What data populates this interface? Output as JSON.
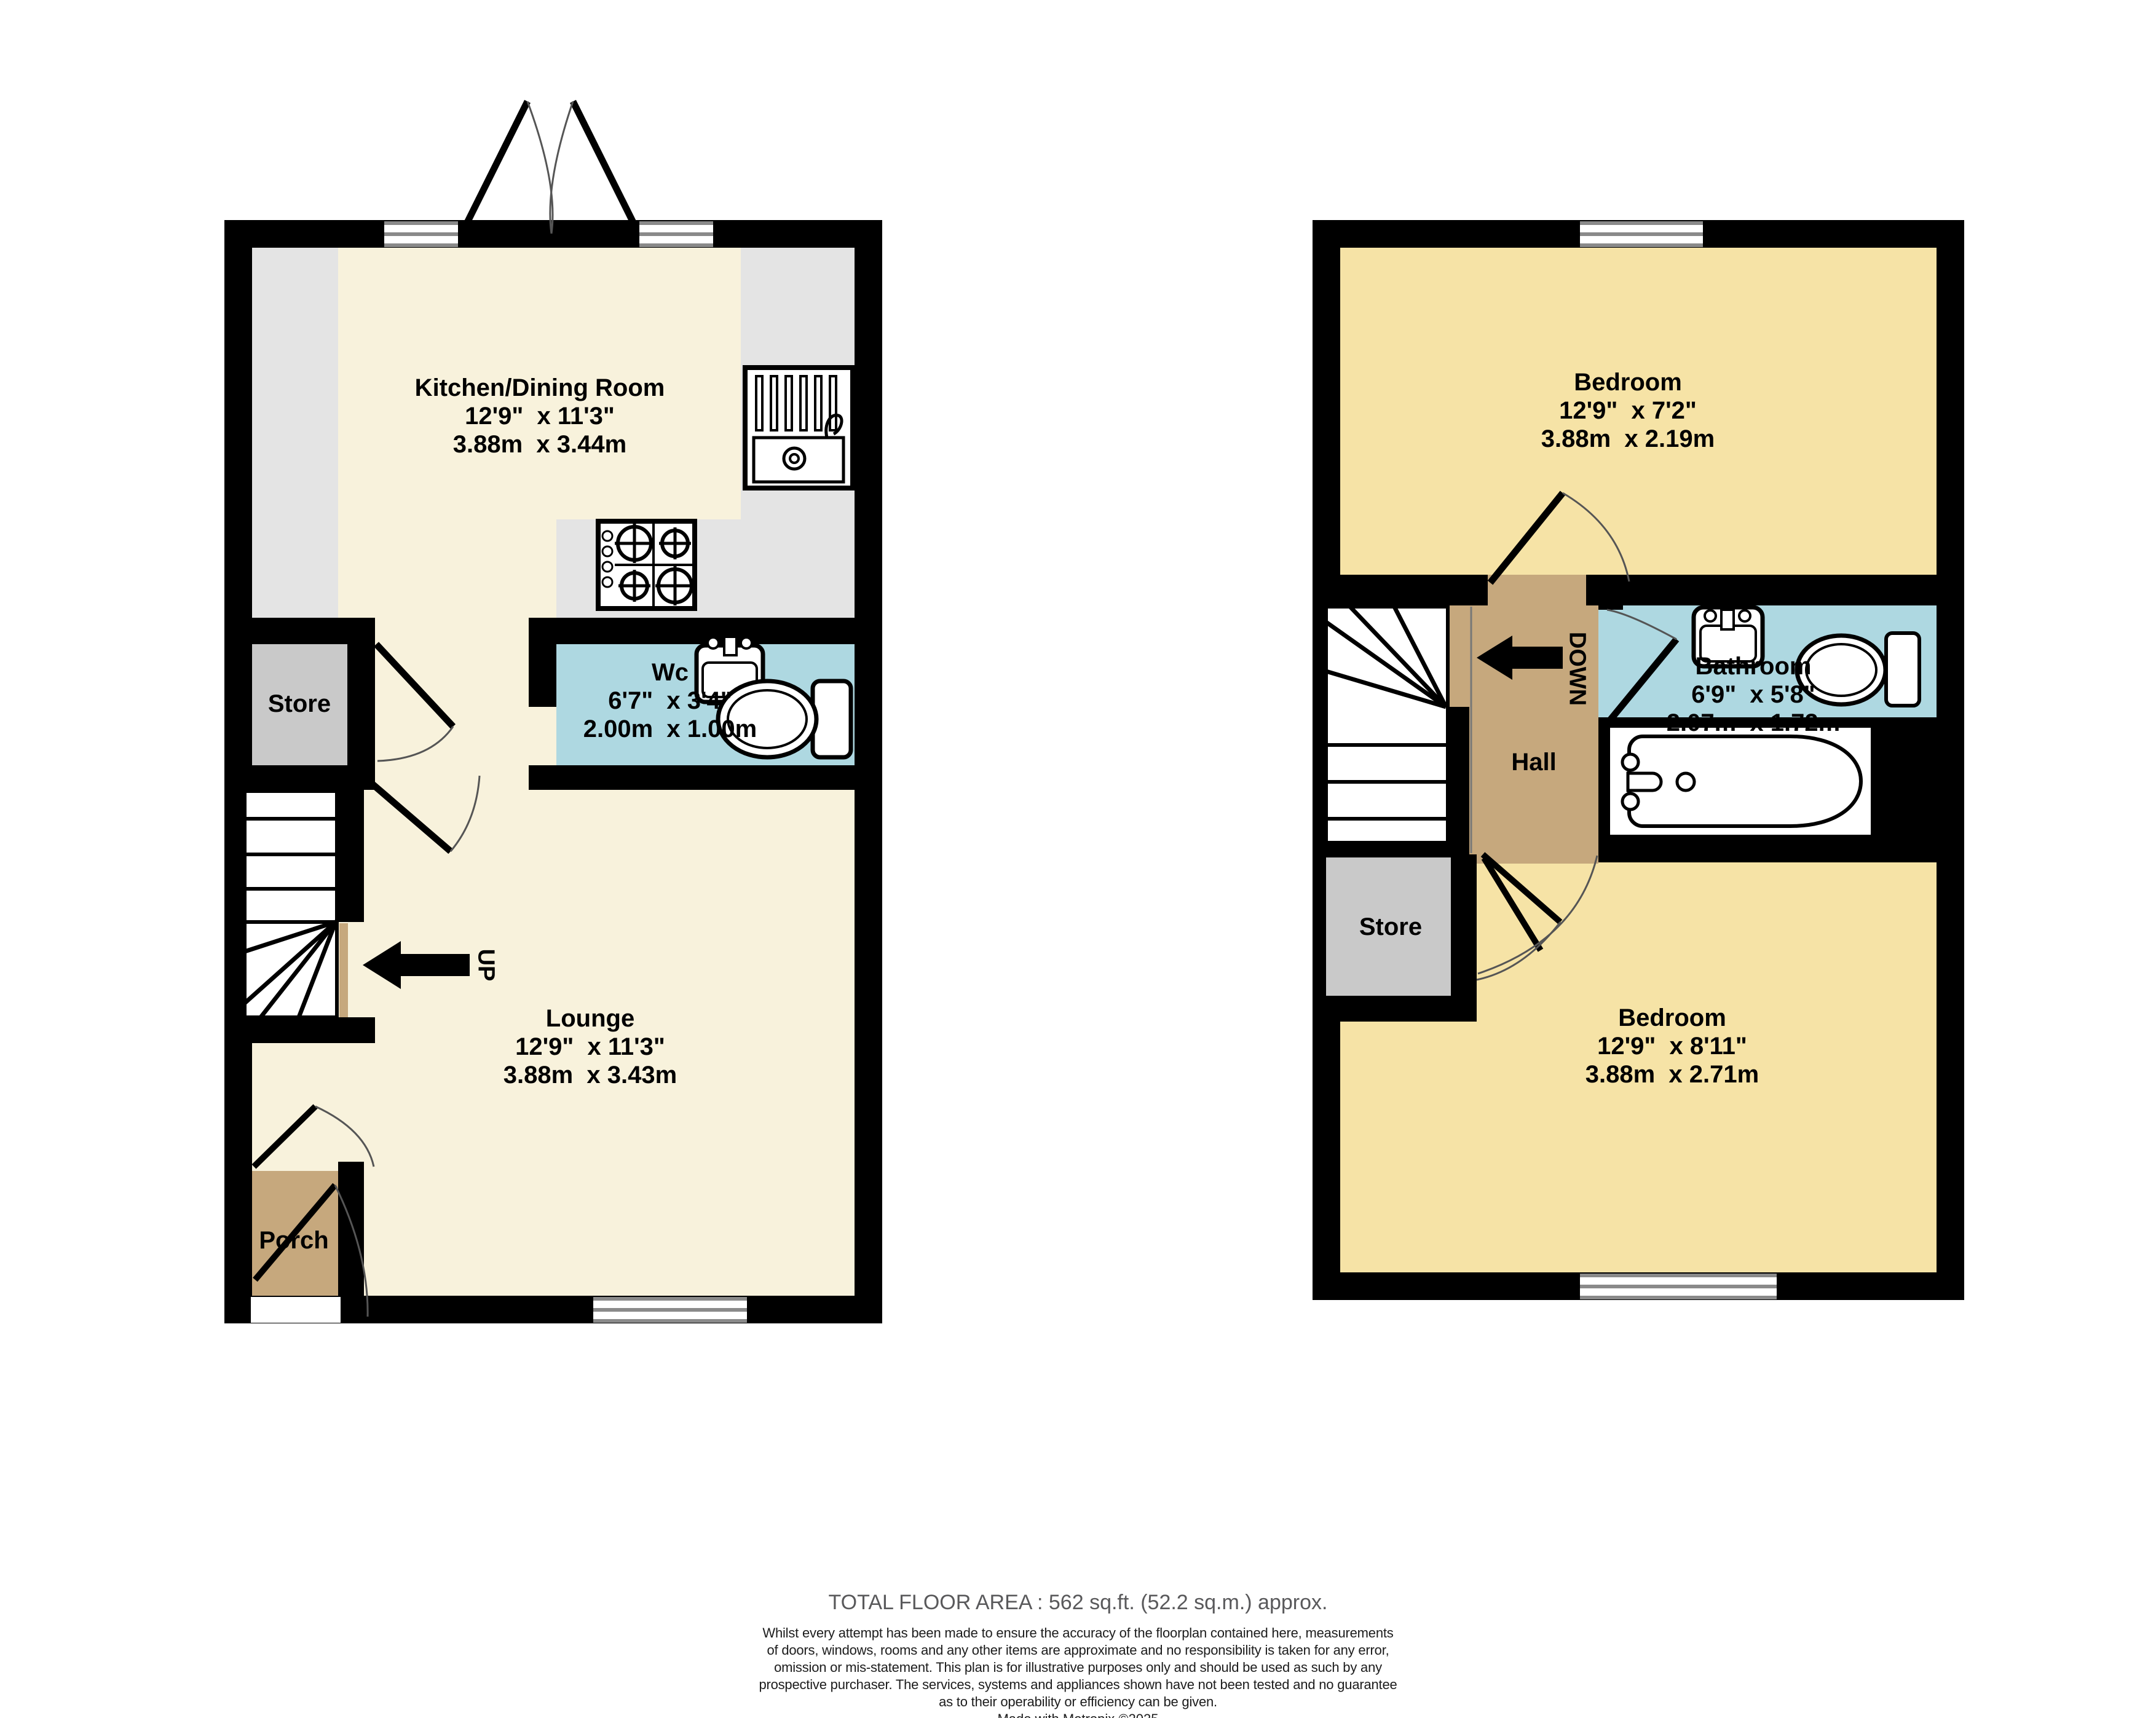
{
  "colors": {
    "wall": "#000000",
    "ground_floor_room": "#f8f2dc",
    "kitchen_counter": "#e4e4e4",
    "store_gray": "#c9c9c9",
    "porch_hall_tan": "#c6a87d",
    "wet_room_blue": "#aed8e1",
    "bedroom_yellow": "#f6e3a6",
    "window_line_gray": "#8a8a8a",
    "footer_title_gray": "#59595b"
  },
  "ground": {
    "kitchen": {
      "name": "Kitchen/Dining Room",
      "imperial": "12'9\"  x 11'3\"",
      "metric": "3.88m  x 3.44m"
    },
    "wc": {
      "name": "Wc",
      "imperial": "6'7\"  x 3'4\"",
      "metric": "2.00m  x 1.00m"
    },
    "store": {
      "name": "Store"
    },
    "lounge": {
      "name": "Lounge",
      "imperial": "12'9\"  x 11'3\"",
      "metric": "3.88m  x 3.43m"
    },
    "porch": {
      "name": "Porch"
    },
    "stair_direction": "UP"
  },
  "first": {
    "bedroom1": {
      "name": "Bedroom",
      "imperial": "12'9\"  x 7'2\"",
      "metric": "3.88m  x 2.19m"
    },
    "bathroom": {
      "name": "Bathroom",
      "imperial": "6'9\"  x 5'8\"",
      "metric": "2.07m  x 1.72m"
    },
    "hall": {
      "name": "Hall"
    },
    "store": {
      "name": "Store"
    },
    "bedroom2": {
      "name": "Bedroom",
      "imperial": "12'9\"  x 8'11\"",
      "metric": "3.88m  x 2.71m"
    },
    "stair_direction": "DOWN"
  },
  "footer": {
    "total_area": "TOTAL FLOOR AREA : 562 sq.ft. (52.2 sq.m.) approx.",
    "disclaimer_lines": [
      "Whilst every attempt has been made to ensure the accuracy of the floorplan contained here, measurements",
      "of doors, windows, rooms and any other items are approximate and no responsibility is taken for any error,",
      "omission or mis-statement. This plan is for illustrative purposes only and should be used as such by any",
      "prospective purchaser. The services, systems and appliances shown have not been tested and no guarantee",
      "as to their operability or efficiency can be given."
    ],
    "credit": "Made with Metropix ©2025"
  }
}
